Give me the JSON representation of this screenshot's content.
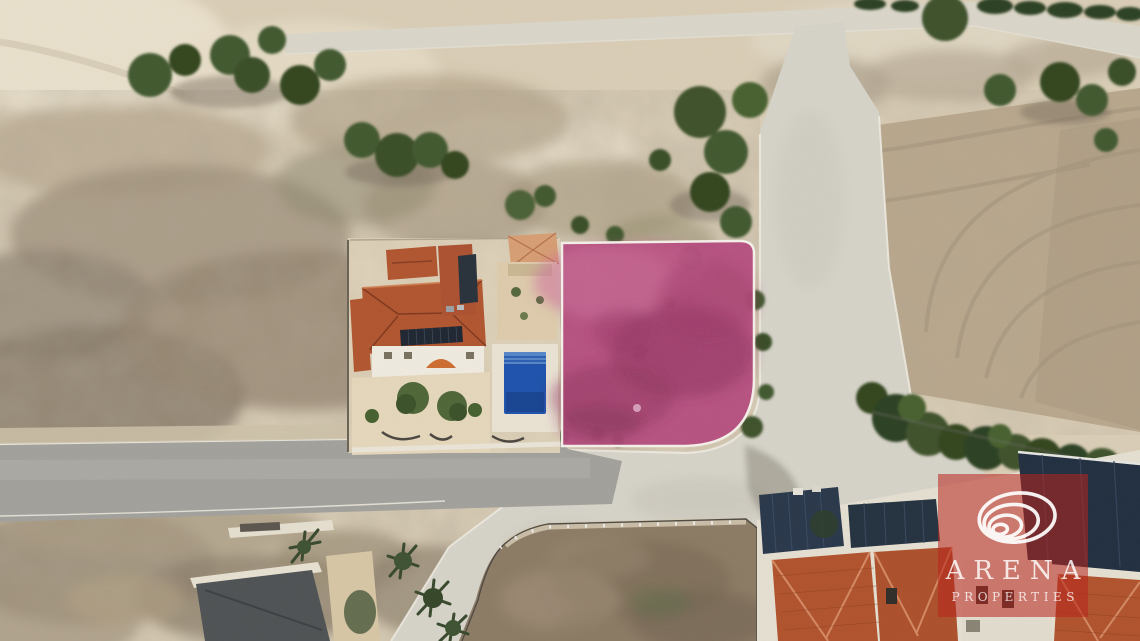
{
  "watermark": {
    "brand": "ARENA",
    "tagline": "PROPERTIES",
    "logo_icon": "swirl-logo-icon"
  },
  "colors": {
    "plot-pink": "#b8437e",
    "plot-pink-dark": "#8e2c5c",
    "plot-pink-light": "#d06f9d",
    "plot-outline": "#f7f3ec",
    "watermark-red": "rgba(184,36,30,0.55)",
    "pool-blue": "#1c52ae",
    "roof-terracotta": "#b2552f",
    "roof-navy": "#27364a",
    "road-asphalt": "#a3a29d",
    "road-concrete": "#d8d5cb",
    "sand": "#dbcfb8",
    "scrub-brown": "#93836e",
    "tree-green": "#41582f",
    "field-tan": "#bba98d"
  }
}
